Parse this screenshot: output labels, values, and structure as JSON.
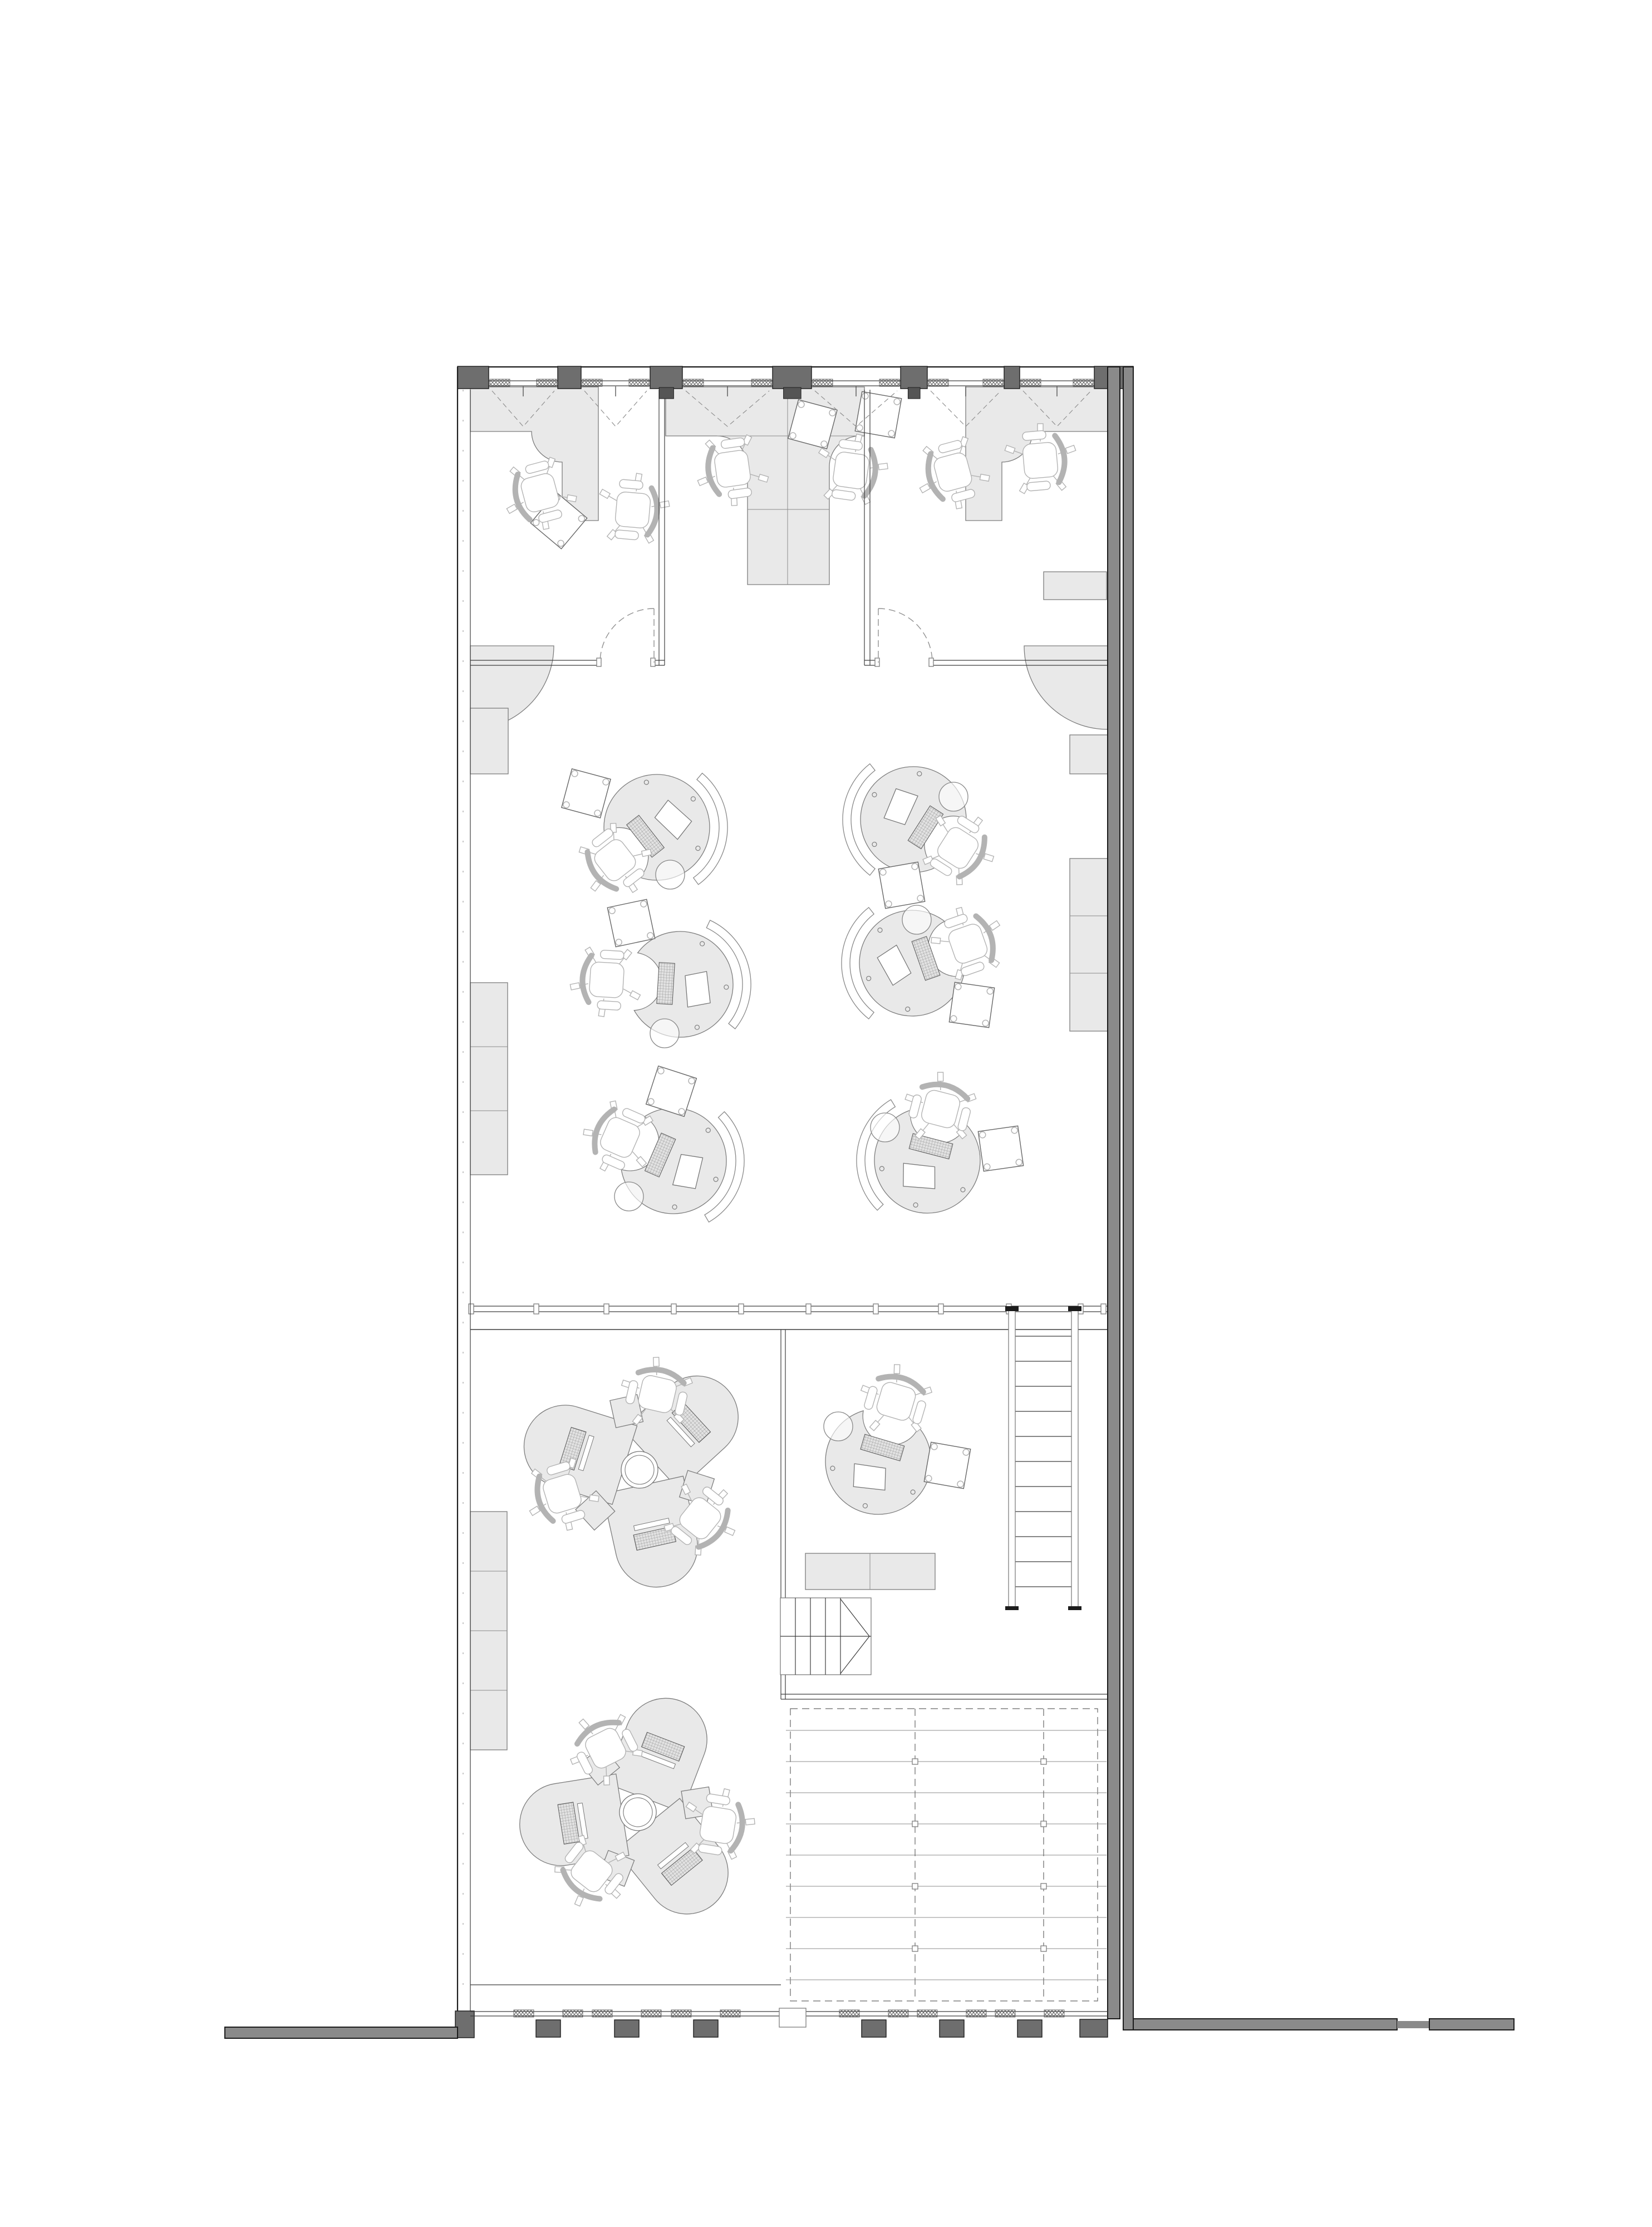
{
  "document": {
    "title": "Office floor plan - top-down monochrome architectural CAD drawing",
    "type": "architectural-floor-plan",
    "drawing_style": "black and grey linework on white, grey-filled furniture",
    "visible_text": []
  },
  "palette": {
    "bg": "#ffffff",
    "wallmid": "#8a8a8a",
    "walldark": "#6e6e6e",
    "tab": "#555555",
    "ink": "#1c1c1c",
    "line": "#3c3c3c",
    "lite": "#8c8c8c",
    "furn": "#e9e9e9",
    "fstroke": "#7d7d7d",
    "chair": "#b3b3b3",
    "dash": "#909090"
  },
  "spaces": [
    {
      "name": "private-office-left",
      "l_shaped_desk": 1,
      "task_chairs": 2,
      "tilted_side_table": 1,
      "door": "dashed quarter swing"
    },
    {
      "name": "private-office-right",
      "l_shaped_desk": 1,
      "task_chairs": 2,
      "tilted_side_table": 1,
      "wall_cabinet": 1,
      "door": "dashed quarter swing"
    },
    {
      "name": "shared-bay-top-centre",
      "t_shaped_double_desk": 1,
      "task_chairs": 2,
      "tilted_side_table": 1
    },
    {
      "name": "open-workspace-middle",
      "circular_workstations": 6,
      "task_chairs": 6,
      "acoustic_screen_arcs": 6,
      "tilted_side_tables": 6,
      "pedestal_rounds": 6,
      "quarter_round_wall_tables": 2,
      "wall_cabinet_stacks": 3
    },
    {
      "name": "studio-lower-left",
      "trefoil_desk_clusters": 2,
      "task_chairs": 6,
      "wall_cabinet_cells": 4
    },
    {
      "name": "room-lower-right",
      "circular_workstation": 1,
      "task_chair": 1,
      "tilted_side_table": 1,
      "low_cabinet_cells": 2
    },
    {
      "name": "main-stair",
      "treads": 11
    },
    {
      "name": "compact-stair",
      "treads": 5,
      "direction_arrow": "chevron"
    },
    {
      "name": "roof-void-grid",
      "beam_lines": 9,
      "dashed_joist_lines": 2,
      "dashed_border": true
    }
  ],
  "envelope": {
    "top_window_bays": 6,
    "bottom_window_piers": 6,
    "glazed_partition_posts": 11,
    "party_wall_side": "right",
    "neighbour_wall_stubs": [
      "bottom-left",
      "bottom-right"
    ]
  }
}
